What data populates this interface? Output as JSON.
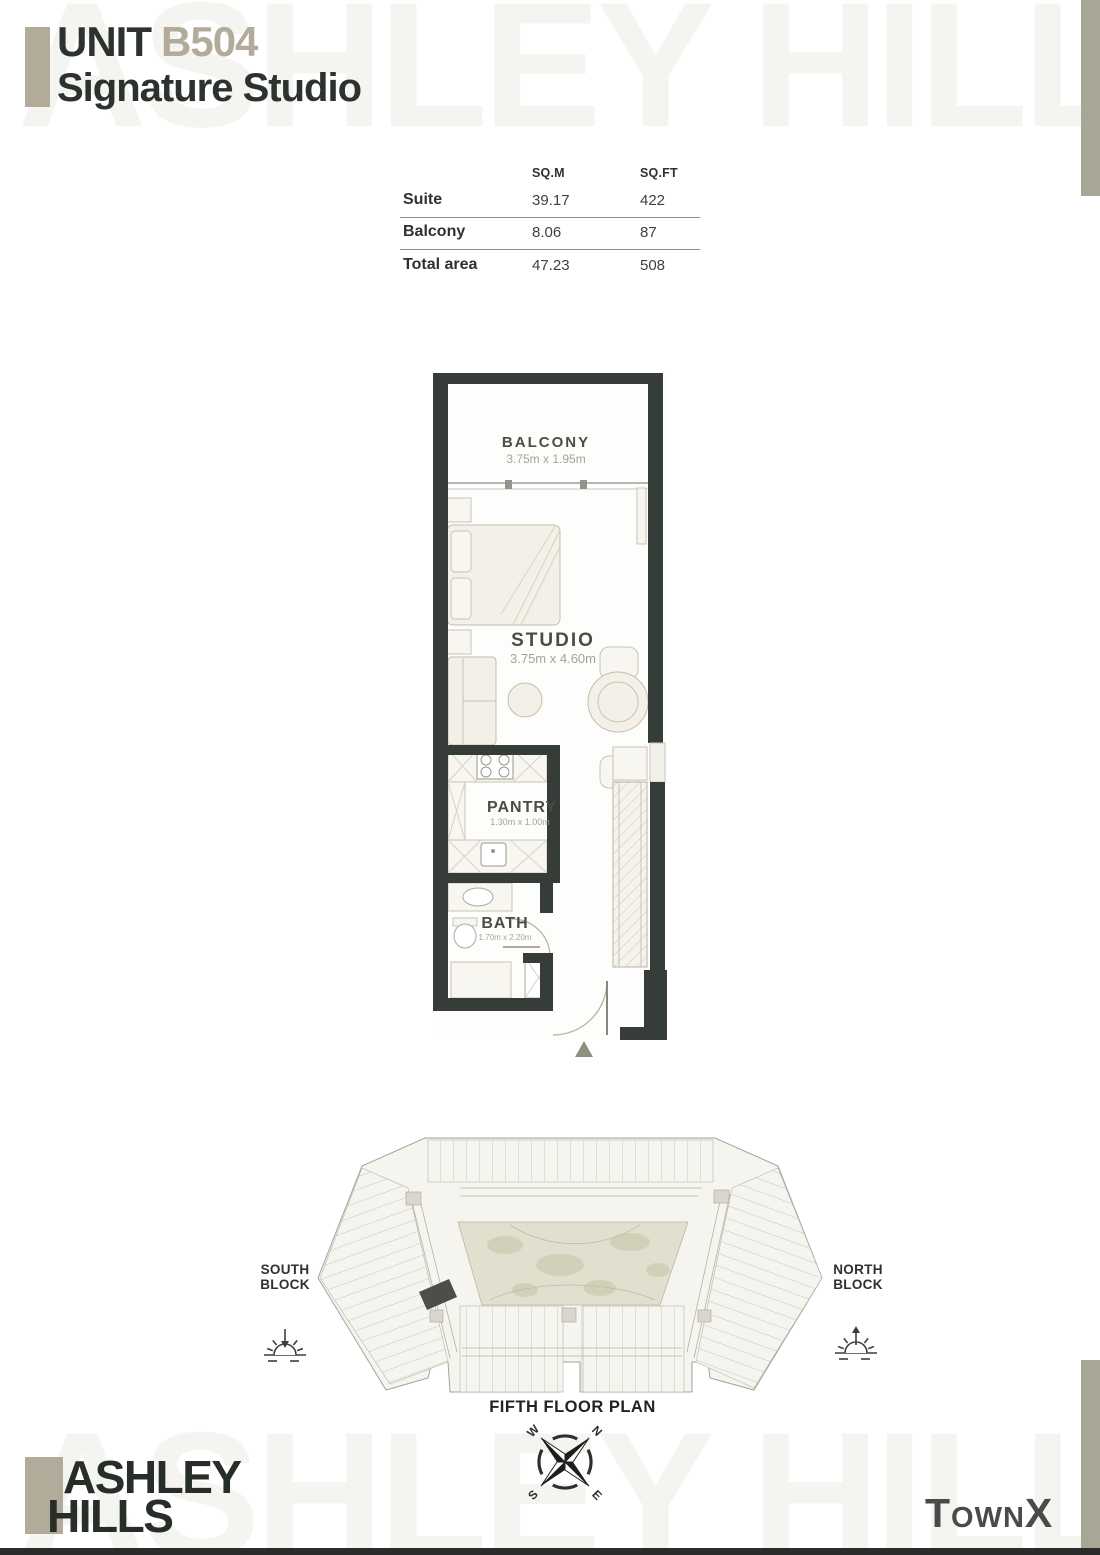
{
  "header": {
    "unit_label": "UNIT",
    "unit_number": "B504",
    "subtitle": "Signature Studio"
  },
  "watermark": "ASHLEY HILLS",
  "area_table": {
    "columns": [
      "SQ.M",
      "SQ.FT"
    ],
    "rows": [
      {
        "label": "Suite",
        "sqm": "39.17",
        "sqft": "422"
      },
      {
        "label": "Balcony",
        "sqm": "8.06",
        "sqft": "87"
      },
      {
        "label": "Total area",
        "sqm": "47.23",
        "sqft": "508"
      }
    ]
  },
  "floor_plan": {
    "rooms": [
      {
        "name": "BALCONY",
        "dimensions": "3.75m x 1.95m"
      },
      {
        "name": "STUDIO",
        "dimensions": "3.75m x 4.60m"
      },
      {
        "name": "PANTRY",
        "dimensions": "1.30m x 1.00m"
      },
      {
        "name": "BATH",
        "dimensions": "1.70m x 2.20m"
      }
    ]
  },
  "site_plan": {
    "south_block": {
      "line1": "SOUTH",
      "line2": "BLOCK"
    },
    "north_block": {
      "line1": "NORTH",
      "line2": "BLOCK"
    },
    "caption": "FIFTH FLOOR PLAN",
    "compass": {
      "n": "N",
      "e": "E",
      "s": "S",
      "w": "W"
    }
  },
  "footer": {
    "brand_line1": "ASHLEY",
    "brand_line2": "HILLS",
    "developer": "TownX"
  },
  "colors": {
    "accent_taupe": "#b2ab99",
    "ink": "#2c332e",
    "wall": "#363c38",
    "watermark": "#f4f4f1",
    "edge_bar": "#a8a695",
    "site_highlight": "#4d4d49",
    "courtyard": "#e1dfcd"
  }
}
